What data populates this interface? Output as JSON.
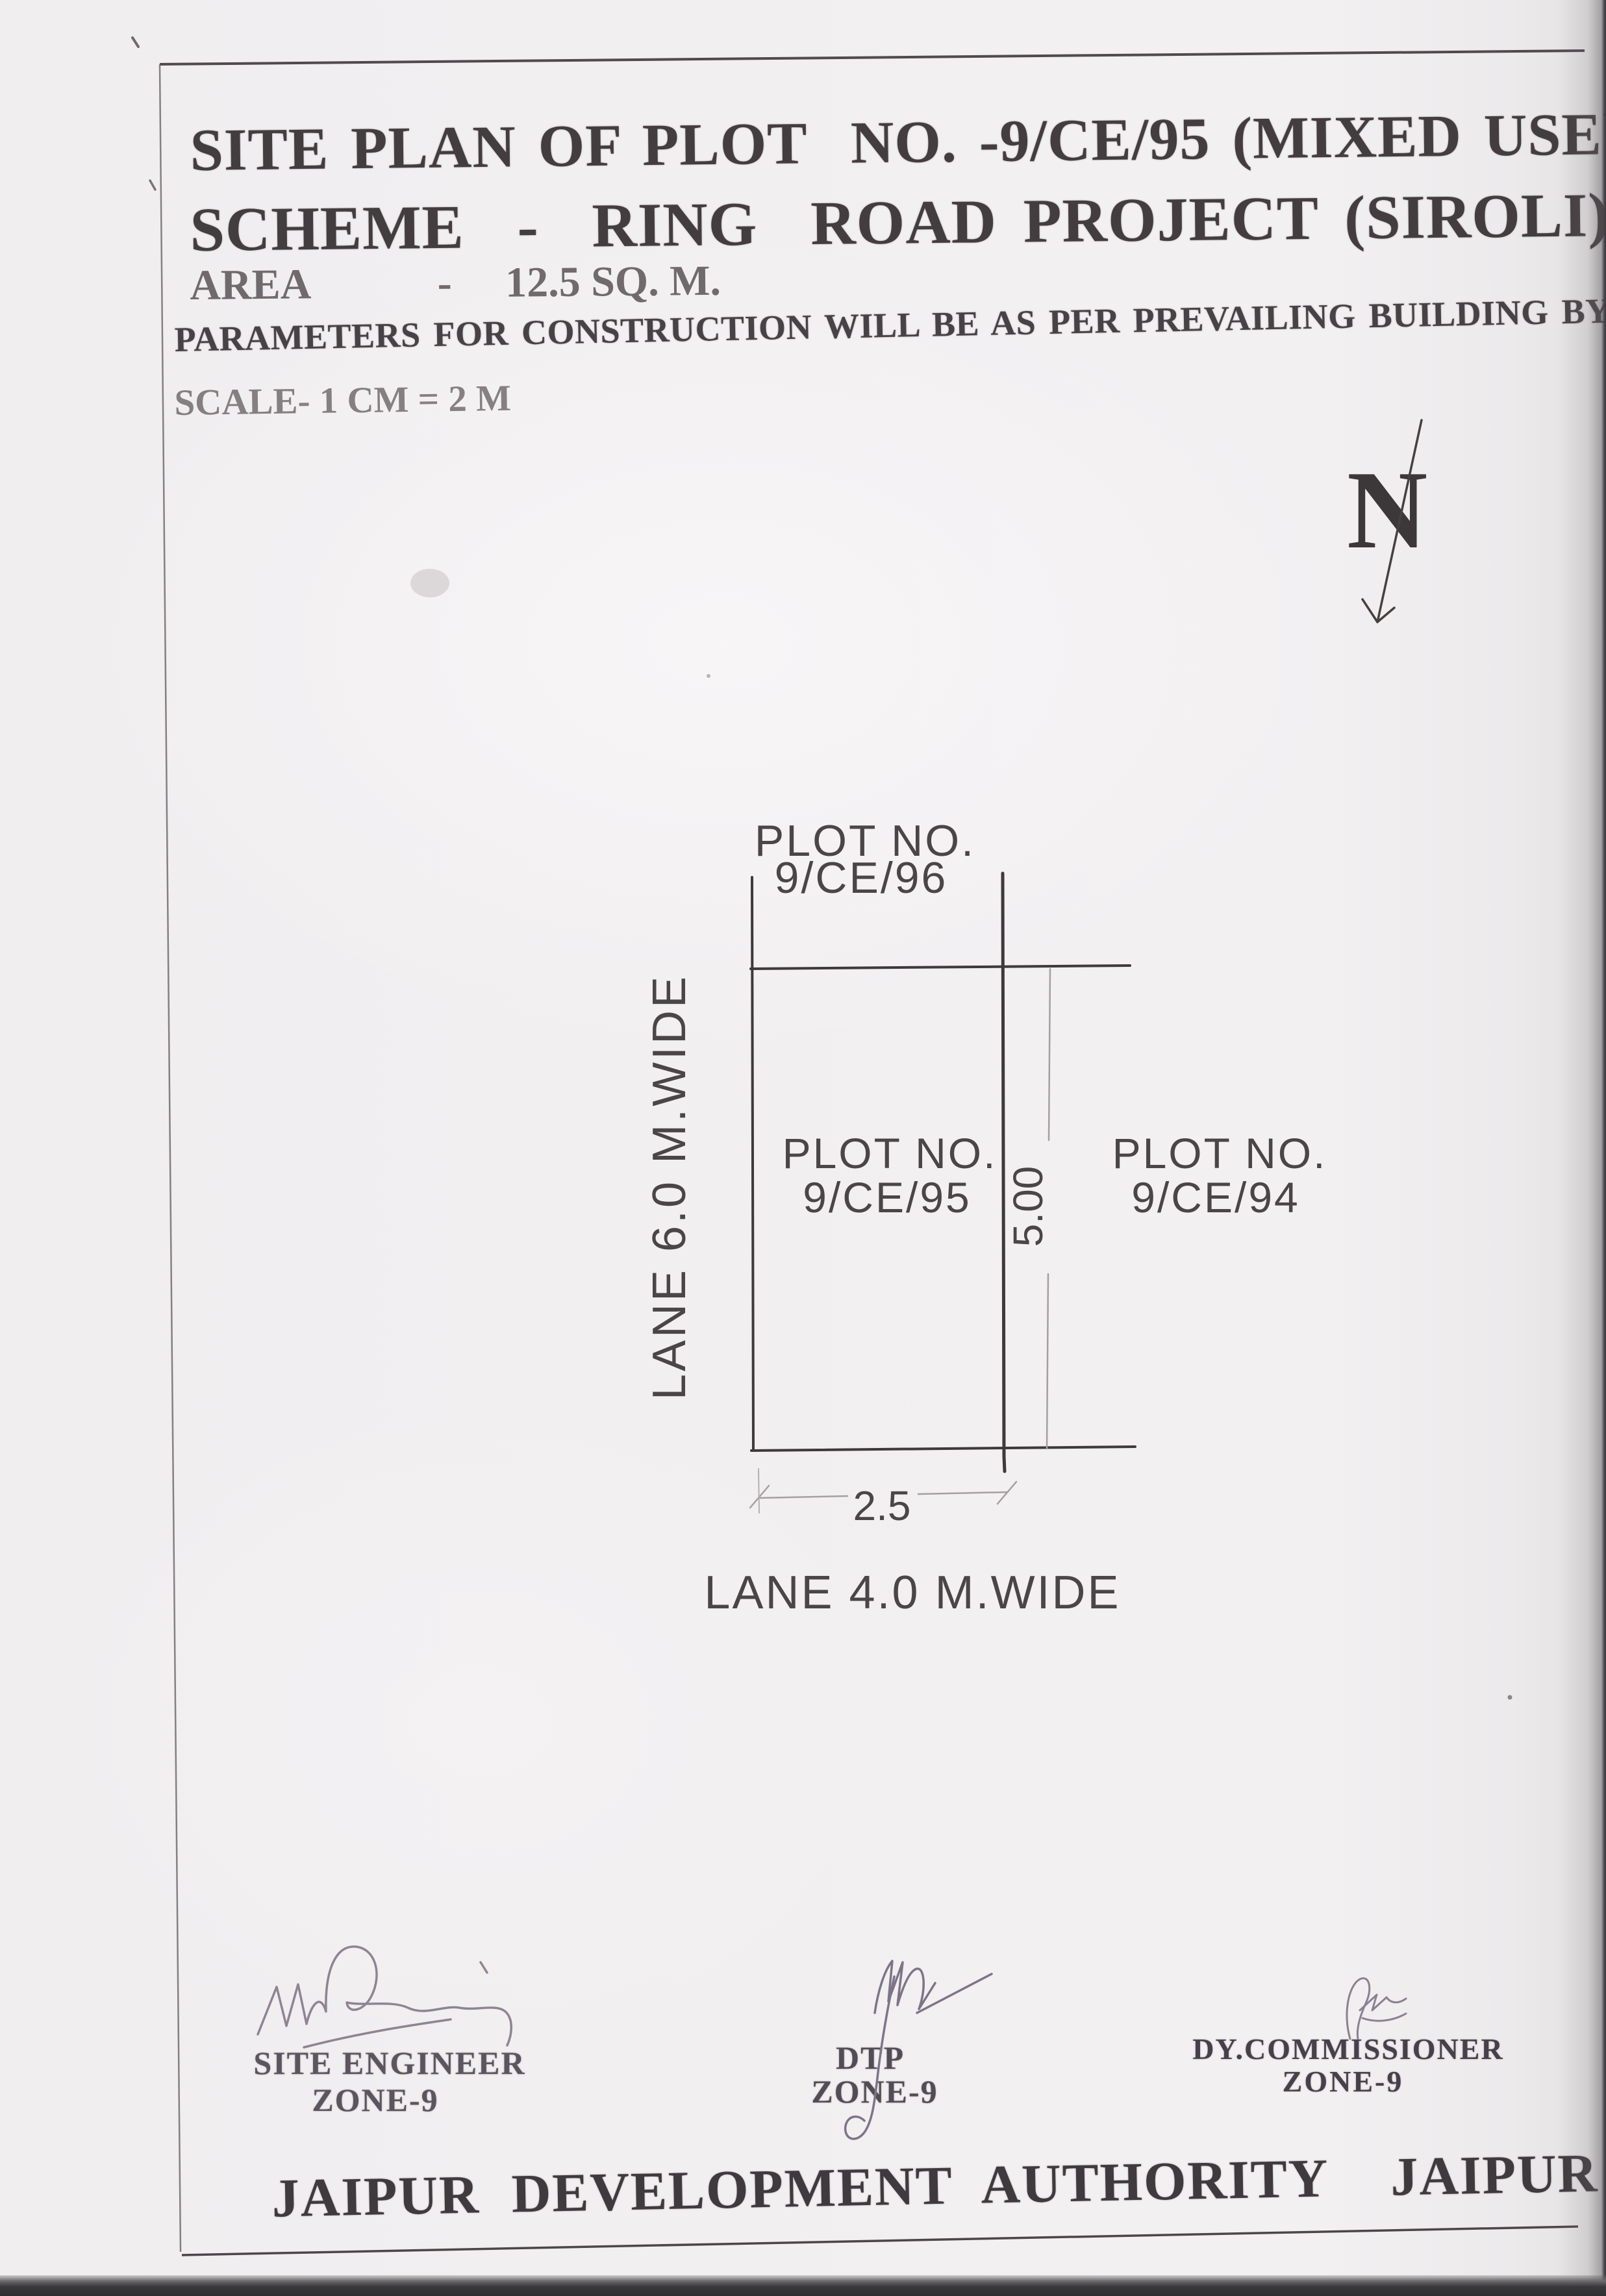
{
  "document": {
    "title_line1": "SITE PLAN OF PLOT  NO. -9/CE/95 (MIXED USE)",
    "title_line2": "SCHEME  -  RING  ROAD PROJECT (SIROLI)",
    "area_line": "AREA            -     12.5 SQ. M.",
    "byelaw_line": "PARAMETERS FOR CONSTRUCTION WILL BE AS PER PREVAILING BUILDING BYE-LAWS",
    "scale_line": "SCALE- 1 CM = 2 M",
    "authority_line": "JAIPUR DEVELOPMENT AUTHORITY  JAIPUR"
  },
  "compass": {
    "north_letter": "N"
  },
  "plan": {
    "plot_top": {
      "line1": "PLOT NO.",
      "line2": "9/CE/96"
    },
    "plot_center": {
      "line1": "PLOT NO.",
      "line2": "9/CE/95"
    },
    "plot_right": {
      "line1": "PLOT NO.",
      "line2": "9/CE/94"
    },
    "lane_left_label": "LANE 6.0 M.WIDE",
    "lane_bottom_label": "LANE 4.0 M.WIDE",
    "width_dimension": "2.5",
    "height_dimension": "5.00"
  },
  "signature_block": {
    "left": {
      "role": "SITE ENGINEER",
      "zone": "ZONE-9"
    },
    "middle": {
      "role": "DTP",
      "zone": "ZONE-9"
    },
    "right": {
      "role": "DY.COMMISSIONER",
      "zone": "ZONE-9"
    }
  },
  "colors": {
    "ink": "#3e393b",
    "stamp_ink": "#524c57",
    "signature_ink": "#8d8494",
    "dimension_line": "#a49fa3",
    "paper": "#f1eff0",
    "scanner_bar": "#2e2d2f"
  }
}
